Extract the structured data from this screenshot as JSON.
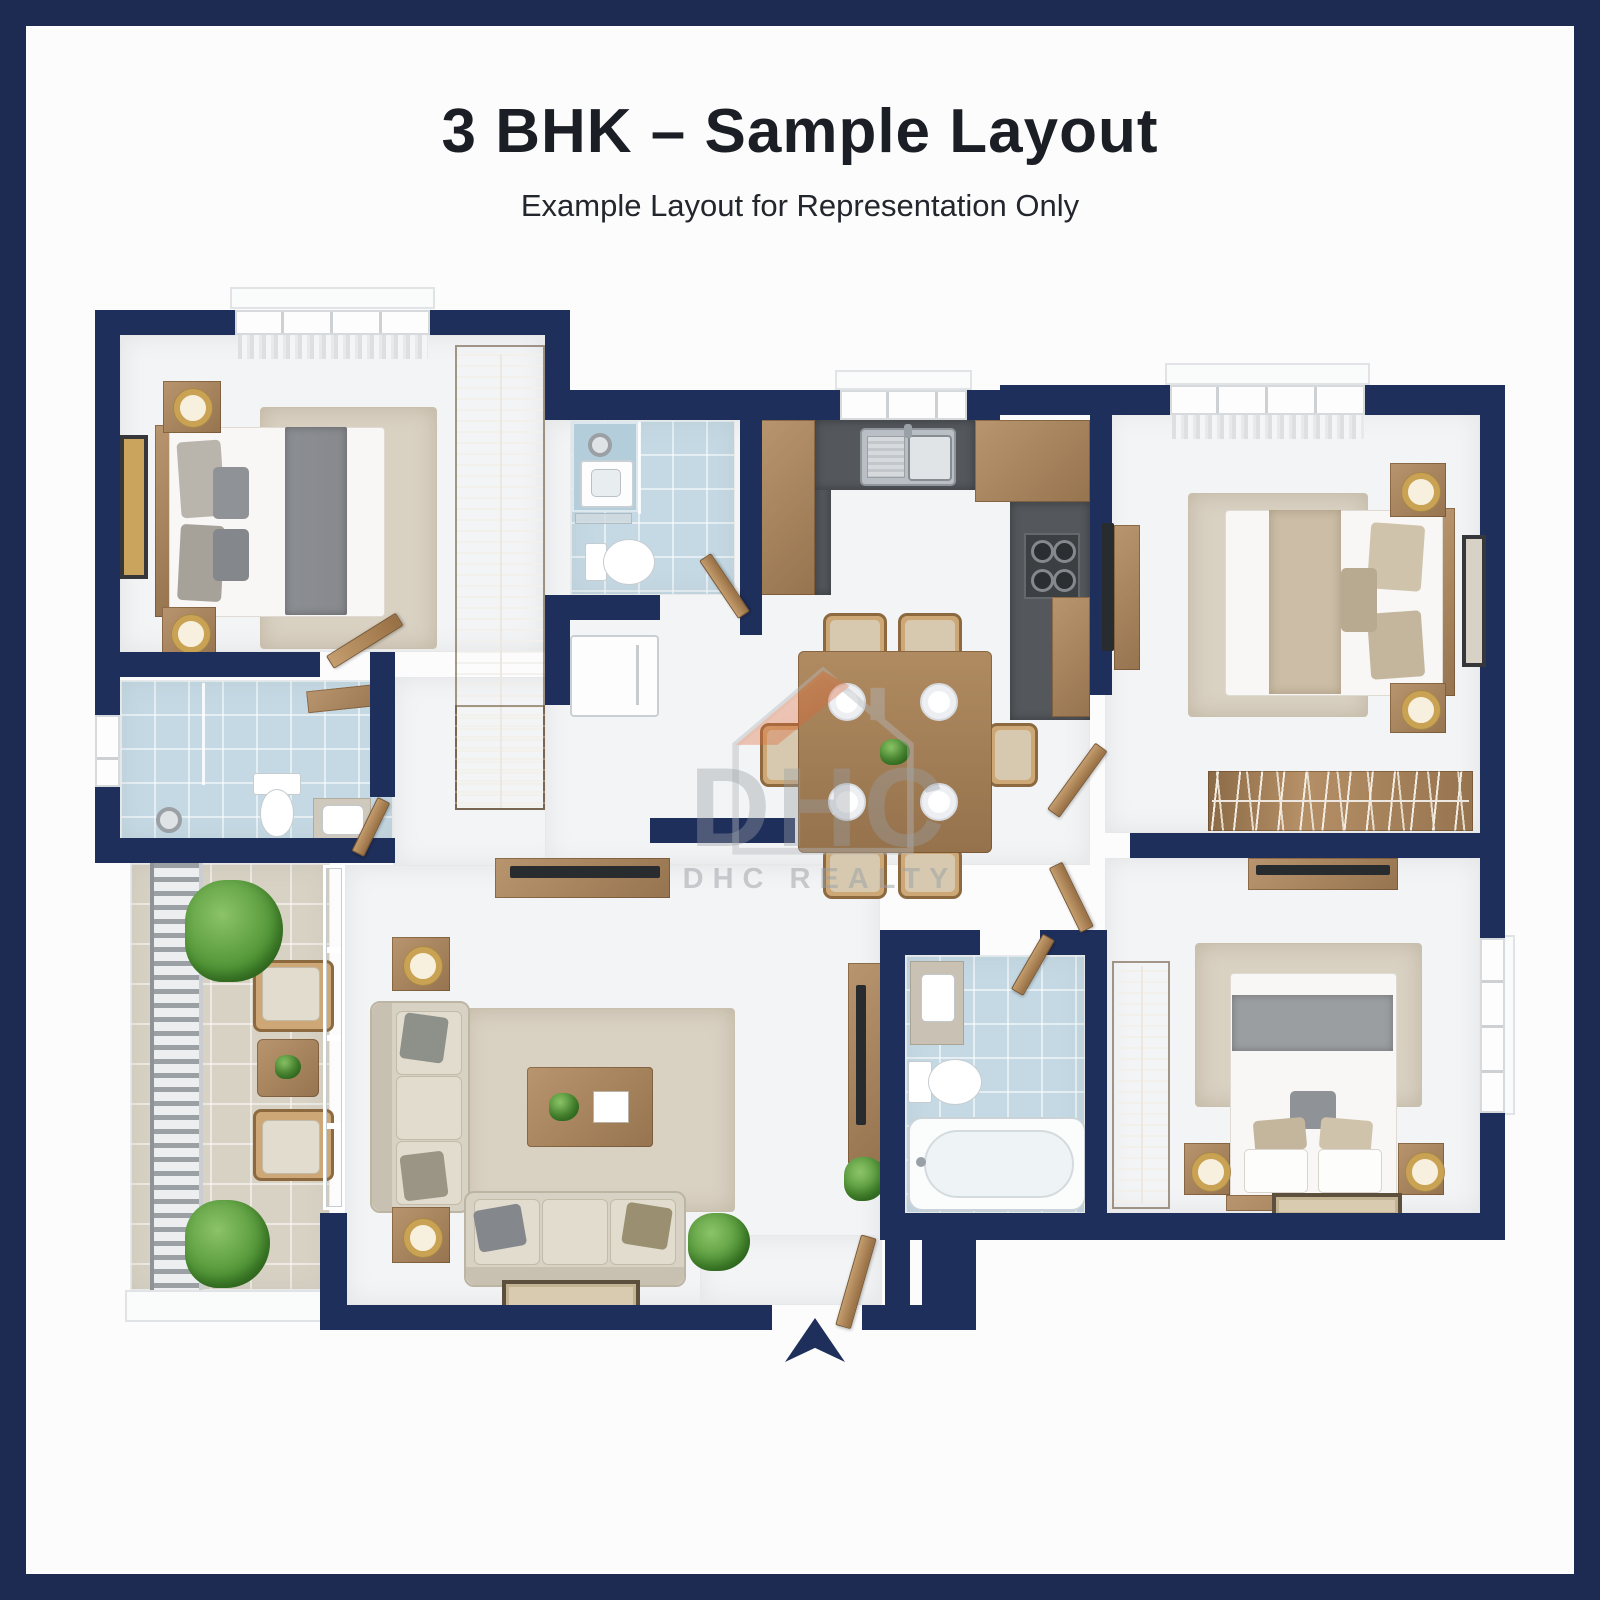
{
  "header": {
    "title": "3 BHK – Sample Layout",
    "subtitle": "Example Layout for Representation Only"
  },
  "watermark": {
    "logo": "DHC",
    "label": "DHC REALTY"
  },
  "icons": {
    "entry_arrow": "up-arrow",
    "watermark_logo": "house-outline"
  },
  "colors": {
    "frame": "#1d2a52",
    "wall": "#1f2f5c",
    "floor": "#f3f4f5",
    "tile_blue": "#c5d9e4",
    "tile_beige": "#d8d2c4",
    "counter": "#54585c",
    "rug": "#d9d1c2",
    "gold": "#c9a254",
    "plant_green": "#55983b",
    "watermark_gray": "#9aa0a6",
    "watermark_orange": "#e87a40",
    "watermark_red": "#d14a28"
  }
}
